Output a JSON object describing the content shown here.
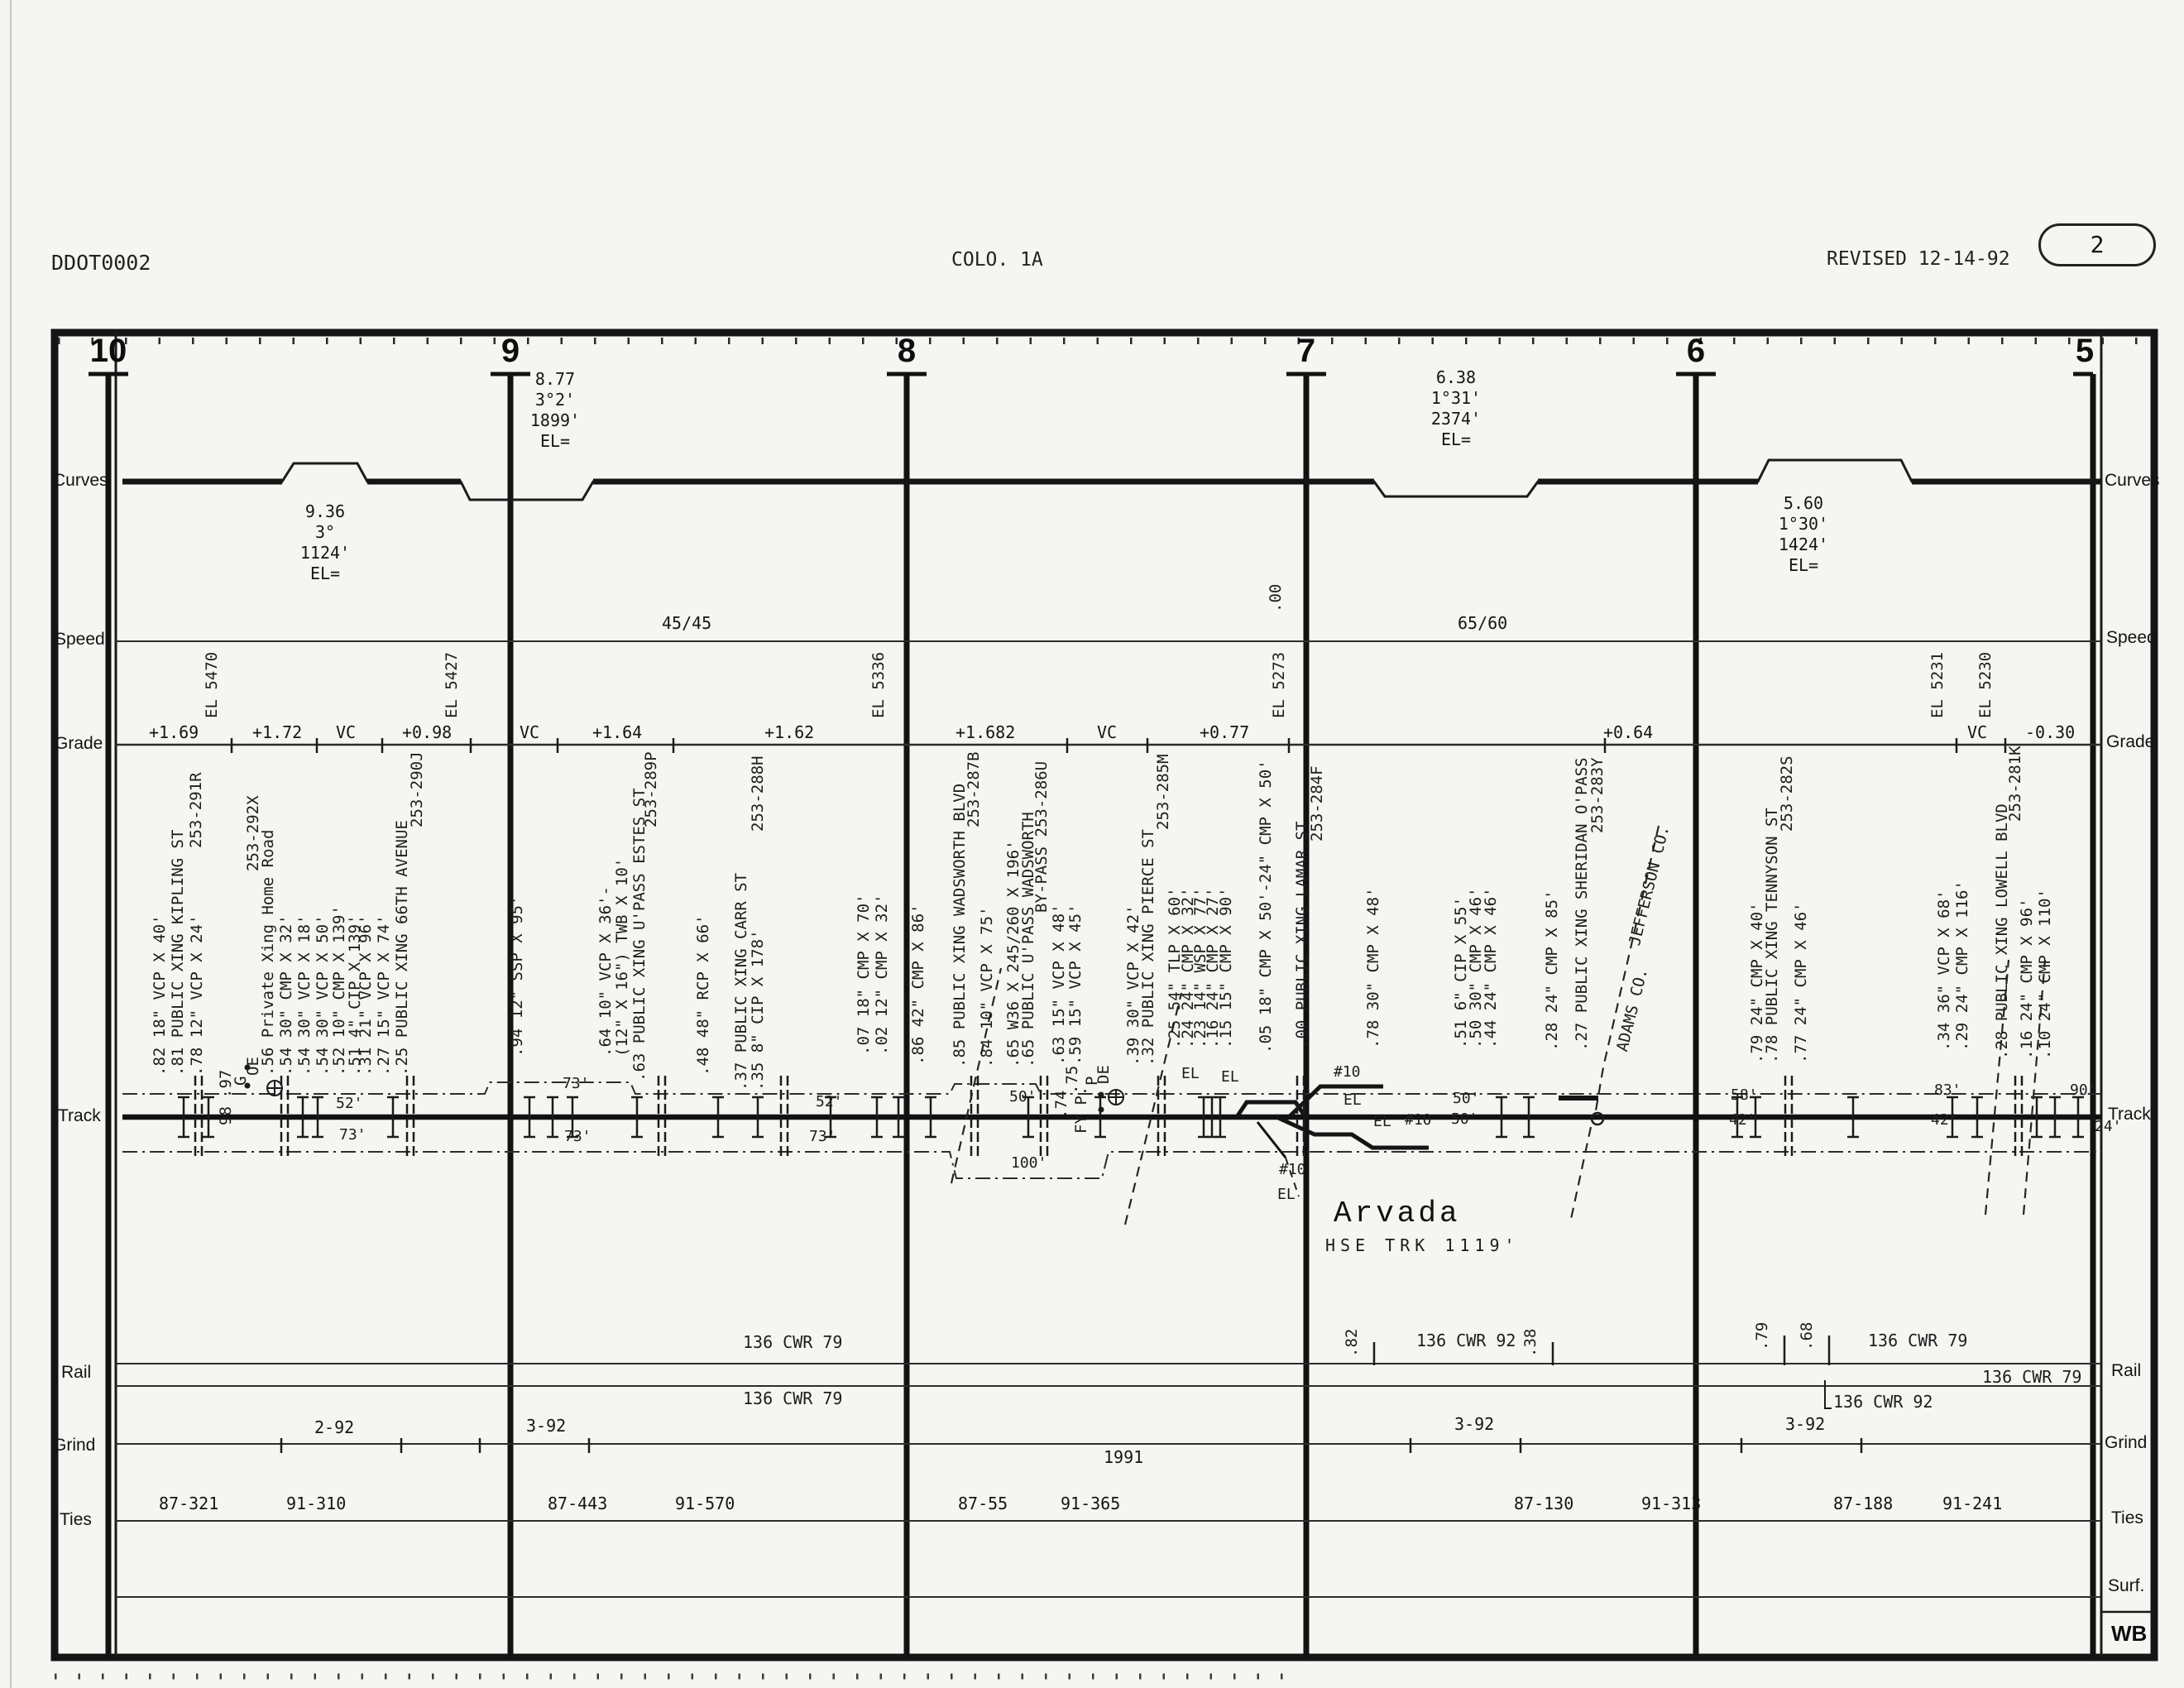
{
  "header": {
    "doc_id": "DDOT0002",
    "sheet": "COLO. 1A",
    "revision": "REVISED 12-14-92",
    "page": "2"
  },
  "side_labels": {
    "left": [
      "Curves",
      "Speed",
      "Grade",
      "Track",
      "Rail",
      "Grind",
      "Ties"
    ],
    "right": [
      "Curves",
      "Speed",
      "Grade",
      "Track",
      "Rail",
      "Grind",
      "Ties",
      "Surf."
    ],
    "direction": "WB"
  },
  "mileposts": [
    "10",
    "9",
    "8",
    "7",
    "6",
    "5"
  ],
  "curves": {
    "blocks": [
      "9.36\n3°\n1124'\nEL=",
      "8.77\n3°2'\n1899'\nEL=",
      "6.38\n1°31'\n2374'\nEL=",
      "5.60\n1°30'\n1424'\nEL="
    ]
  },
  "speed": {
    "zones": [
      "45/45",
      "65/60"
    ],
    "milepost_marker": ".00"
  },
  "grade": {
    "segments": [
      "+1.69",
      "+1.72",
      "VC",
      "+0.98",
      "VC",
      "+1.64",
      "+1.62",
      "+1.682",
      "VC",
      "+0.77",
      "+0.64",
      "VC",
      "-0.30"
    ],
    "elevations": [
      "EL 5470",
      "EL 5427",
      "EL 5336",
      "EL 5273",
      "EL 5231",
      "EL 5230"
    ]
  },
  "features": [
    ".82 18\" VCP X 40'",
    ".81 PUBLIC XING KIPLING ST",
    "253-291R",
    ".78 12\" VCP X 24'",
    ".97",
    "G",
    "OE",
    "98",
    "253-292X",
    ".56 Private Xing Home Road",
    ".54 30\" CMP X 32'",
    ".54 30\" VCP X 18'",
    ".54 30\" VCP X 50'",
    ".52 10\" CMP X 139'",
    ".51 4\" CIP X 139'",
    ".31 21\" VCP X 96'",
    ".27 15\" VCP X 74'",
    ".25 PUBLIC XING 66TH AVENUE",
    "253-290J",
    ".94 12\" SSP X 95'",
    ".64 10\" VCP X 36'-",
    "(12\" X 16\") TWB X 10'",
    ".63 PUBLIC XING U'PASS ESTES ST",
    "253-289P",
    ".48 48\" RCP X 66'",
    ".37 PUBLIC XING CARR ST",
    ".35 8\" CIP X 178'",
    "253-288H",
    ".07 18\" CMP X 70'",
    ".02 12\" CMP X 32'",
    ".86 42\" CMP X 86'",
    ".85 PUBLIC XING WADSWORTH BLVD",
    "253-287B",
    ".84 10\" VCP X 75'",
    ".65 W36 X 245/260 X 196'",
    ".65 PUBLIC U'PASS WADSWORTH",
    "BY-PASS 253-286U",
    ".63 15\" VCP X 48'",
    ".59 15\" VCP X 45'",
    ".75",
    "P",
    "DE",
    ".74",
    "FY P.",
    ".39 30\" VCP X 42'",
    ".32 PUBLIC XING PIERCE ST",
    "253-285M",
    ".25 54\" TLP X 60'",
    ".24 24\" CMP X 32'",
    ".23 14\" WSP X 77'",
    ".16 24\" CMP X 27'",
    ".15 15\" CMP X 90'",
    "EL",
    ".05 18\" CMP X 50'-24\" CMP X 50'",
    ".00 PUBLIC XING LAMAR ST",
    "253-284F",
    ".78 30\" CMP X 48'",
    ".51 6\" CIP X 55'",
    ".50 30\" CMP X 46'",
    ".44 24\" CMP X 46'",
    ".28 24\" CMP X 85'",
    ".27 PUBLIC XING SHERIDAN O'PASS",
    "253-283Y",
    ".79 24\" CMP X 40'",
    ".78 PUBLIC XING TENNYSON ST",
    "253-282S",
    ".77 24\" CMP X 46'",
    ".34 36\" VCP X 68'",
    ".29 24\" CMP X 116'",
    ".28 PUBLIC XING LOWELL BLVD",
    "253-281K",
    ".16 24\" CMP X 96'",
    ".10 24\" CMP X 110'"
  ],
  "track_notes": [
    "52'",
    "73'",
    "73'",
    "73'",
    "52'",
    "73'",
    "50'",
    "100'",
    "EL",
    "#10",
    "EL",
    "EL",
    "#10",
    "#10",
    "EL",
    "50'",
    "50'",
    "58'",
    "42'",
    "83'",
    "42'",
    "90'",
    "24'"
  ],
  "station": {
    "name": "Arvada",
    "house_track": "HSE TRK 1119'"
  },
  "counties": {
    "north": "JEFFERSON CO.",
    "south": "ADAMS CO."
  },
  "rail": {
    "labels": [
      "136 CWR 79",
      "136 CWR 79",
      "136 CWR 92",
      "136 CWR 79",
      "136 CWR 79",
      "136 CWR 92"
    ],
    "markers": [
      ".82",
      ".38",
      ".79",
      ".68"
    ]
  },
  "grind": {
    "labels": [
      "2-92",
      "3-92",
      "1991",
      "3-92",
      "3-92"
    ]
  },
  "ties": {
    "values": [
      "87-321",
      "91-310",
      "87-443",
      "91-570",
      "87-55",
      "91-365",
      "87-130",
      "91-313",
      "87-188",
      "91-241"
    ]
  }
}
